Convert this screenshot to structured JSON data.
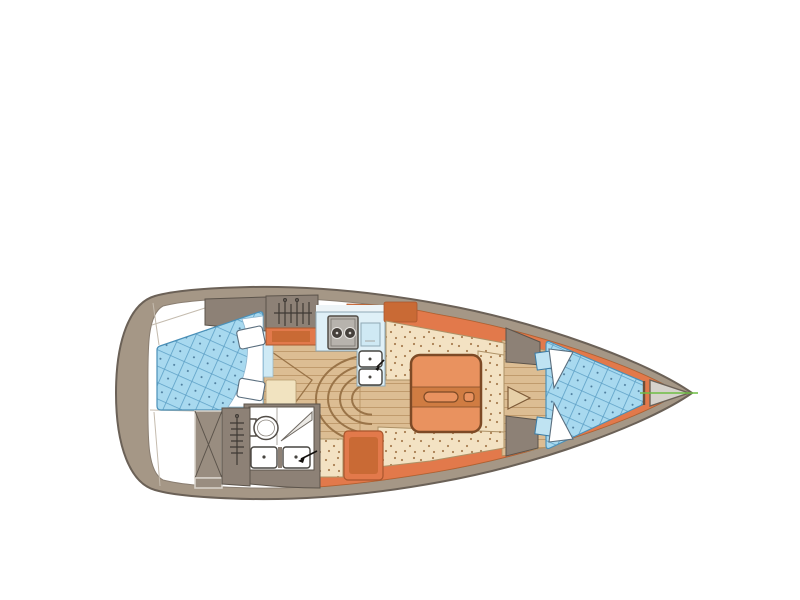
{
  "diagram": {
    "type": "yacht-interior-floor-plan",
    "orientation": "bow-right",
    "background": "#ffffff",
    "rooms": [
      {
        "id": "stern-lazarette",
        "label": "stern lazarette"
      },
      {
        "id": "aft-cabin",
        "label": "aft double cabin with quilted berth and two pillows"
      },
      {
        "id": "aft-hanging-locker",
        "label": "hanging locker with clothes-rail symbol"
      },
      {
        "id": "companionway",
        "label": "companionway with curved steps"
      },
      {
        "id": "galley",
        "label": "galley with two-burner stove and double sink"
      },
      {
        "id": "head",
        "label": "head with toilet, shower and twin basins"
      },
      {
        "id": "wet-locker",
        "label": "cross-braced locker"
      },
      {
        "id": "saloon",
        "label": "U-shaped settee with folding table"
      },
      {
        "id": "fore-passage",
        "label": "passage with door swing to forecabin"
      },
      {
        "id": "v-berth",
        "label": "V-berth forecabin with quilted mattress and two pillows"
      },
      {
        "id": "anchor-locker",
        "label": "anchor locker at bow"
      }
    ],
    "icons": [
      "hanger-rail-icon",
      "steps-icon",
      "door-swing-icon",
      "stove-burner-icon",
      "sink-icon",
      "faucet-icon",
      "toilet-icon",
      "shower-icon",
      "x-brace-icon",
      "pillow-icon",
      "centerline-icon"
    ]
  },
  "palette": {
    "hull": "#a59786",
    "hull-stroke": "#6b6157",
    "interior": "#ffffff",
    "lining": "#e2794b",
    "lining-dark": "#c96a35",
    "cabinet": "#8d8176",
    "cabinet-stroke": "#5c544b",
    "locker-light": "#998d80",
    "wood": "#dcbd93",
    "wood-line": "#c09b6d",
    "quilt": "#a8d9ef",
    "quilt-line": "#5da0c6",
    "speckle": "#f3e2c3",
    "speckle-dot": "#a97f52",
    "counter": "#dff0f7",
    "anchor": "#d6d2cc",
    "centerline": "#6fbe44",
    "table": "#e9925f",
    "table-band": "#d07c42",
    "table-stroke": "#7d4a26"
  }
}
